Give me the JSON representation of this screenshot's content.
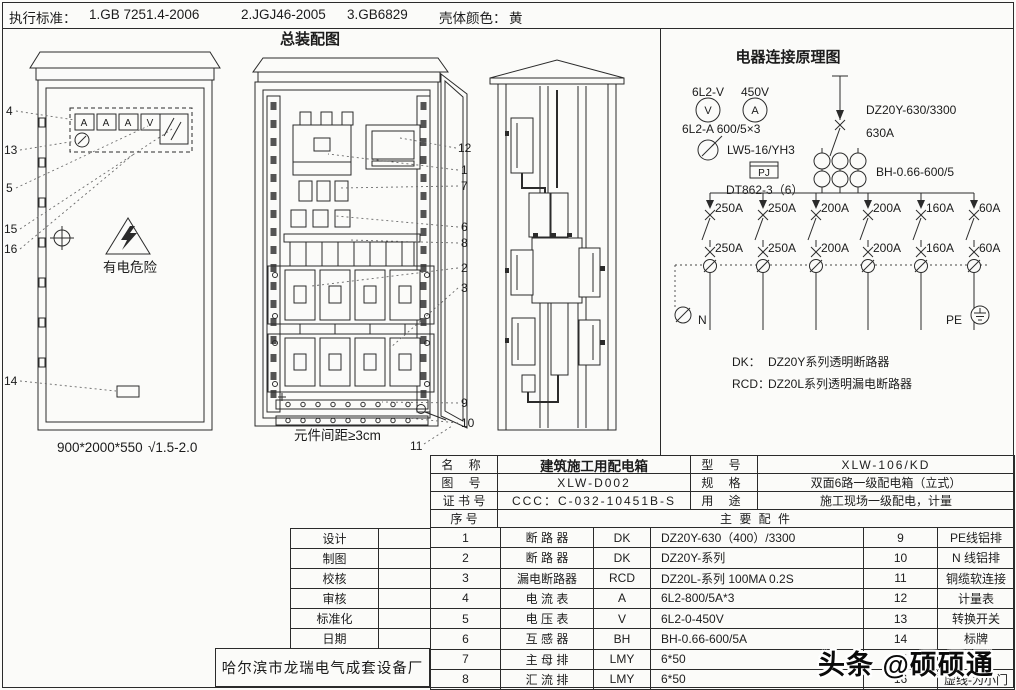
{
  "header": {
    "label": "执行标准：",
    "standards": [
      "1.GB 7251.4-2006",
      "2.JGJ46-2005",
      "3.GB6829"
    ],
    "shell_color_label": "壳体颜色：",
    "shell_color_value": "黄"
  },
  "assembly": {
    "title": "总装配图",
    "warning_text": "有电危险",
    "meter_labels": [
      "A",
      "A",
      "A",
      "V"
    ],
    "cabinet1_caption": "900*2000*550",
    "cabinet1_caption2": "√1.5-2.0",
    "cabinet2_caption": "元件间距≥3cm",
    "cabinet2_caption_num": "11",
    "callouts_left": [
      "4",
      "13",
      "5",
      "15",
      "16",
      "14"
    ],
    "callouts_right": [
      "12",
      "1",
      "7",
      "6",
      "8",
      "2",
      "3",
      "9",
      "10"
    ]
  },
  "schematic": {
    "title": "电器连接原理图",
    "voltmeter_label": "6L2-V",
    "voltmeter_range": "450V",
    "voltmeter_symbol": "V",
    "ammeter_symbol": "A",
    "ammeter_label": "6L2-A 600/5×3",
    "switch_label": "LW5-16/YH3",
    "pj_label": "PJ",
    "energy_meter_label": "DT862-3（6）",
    "main_breaker_label": "DZ20Y-630/3300",
    "main_breaker_rating": "630A",
    "ct_label": "BH-0.66-600/5",
    "branches": [
      {
        "top": "250A",
        "bottom": "250A"
      },
      {
        "top": "250A",
        "bottom": "250A"
      },
      {
        "top": "200A",
        "bottom": "200A"
      },
      {
        "top": "200A",
        "bottom": "200A"
      },
      {
        "top": "160A",
        "bottom": "160A"
      },
      {
        "top": "60A",
        "bottom": "60A"
      }
    ],
    "n_label": "N",
    "pe_label": "PE",
    "legend": [
      {
        "key": "DK：",
        "value": "DZ20Y系列透明断路器"
      },
      {
        "key": "RCD：",
        "value": "DZ20L系列透明漏电断路器"
      }
    ]
  },
  "table": {
    "info": [
      {
        "label": "名    称",
        "value": "建筑施工用配电箱",
        "label2": "型    号",
        "value2": "XLW-106/KD"
      },
      {
        "label": "图    号",
        "value": "XLW-D002",
        "label2": "规    格",
        "value2": "双面6路一级配电箱（立式）"
      },
      {
        "label": "证 书 号",
        "value": "CCC：C-032-10451B-S",
        "label2": "用    途",
        "value2": "施工现场一级配电，计量"
      }
    ],
    "seq_header": "序    号",
    "parts_header": "主  要  配  件",
    "parts": [
      {
        "no": "1",
        "name": "断  路  器",
        "code": "DK",
        "spec": "DZ20Y-630（400）/3300",
        "no2": "9",
        "name2": "PE线铝排"
      },
      {
        "no": "2",
        "name": "断  路  器",
        "code": "DK",
        "spec": "DZ20Y-系列",
        "no2": "10",
        "name2": "N 线铝排"
      },
      {
        "no": "3",
        "name": "漏电断路器",
        "code": "RCD",
        "spec": "DZ20L-系列  100MA 0.2S",
        "no2": "11",
        "name2": "铜缆软连接"
      },
      {
        "no": "4",
        "name": "电  流  表",
        "code": "A",
        "spec": "6L2-800/5A*3",
        "no2": "12",
        "name2": "计量表"
      },
      {
        "no": "5",
        "name": "电  压  表",
        "code": "V",
        "spec": "6L2-0-450V",
        "no2": "13",
        "name2": "转换开关"
      },
      {
        "no": "6",
        "name": "互  感  器",
        "code": "BH",
        "spec": "BH-0.66-600/5A",
        "no2": "14",
        "name2": "标牌"
      },
      {
        "no": "7",
        "name": "主  母  排",
        "code": "LMY",
        "spec": "6*50",
        "no2": "15",
        "name2": ""
      },
      {
        "no": "8",
        "name": "汇  流  排",
        "code": "LMY",
        "spec": "6*50",
        "no2": "16",
        "name2": "虚线-为小门"
      }
    ],
    "admin_rows": [
      "设计",
      "制图",
      "校核",
      "审核",
      "标准化",
      "日期"
    ],
    "manufacturer": "哈尔滨市龙瑞电气成套设备厂"
  },
  "watermark": "头条 @硕硕通"
}
